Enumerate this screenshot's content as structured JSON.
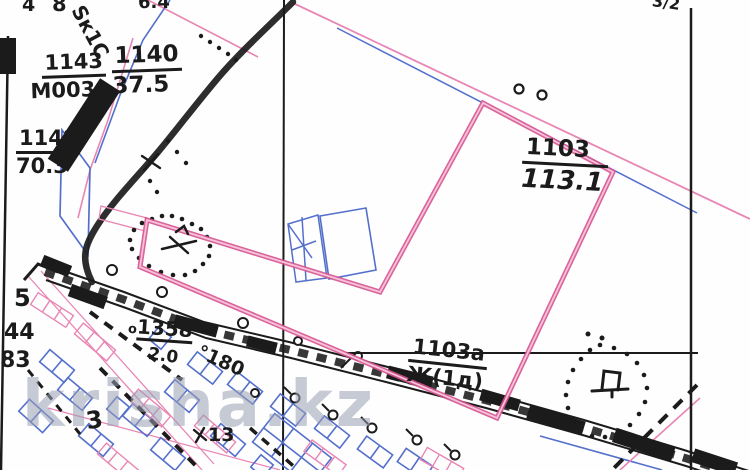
{
  "map": {
    "type": "cadastral-plan-scan",
    "watermark": "krisha.kz",
    "colors": {
      "parcel_outline": "#d6538f",
      "thin_pink": "#e886b4",
      "survey_blue": "#5470cc",
      "ink": "#1b1b1b",
      "watermark_gray": "#9aa0b5"
    },
    "labels": {
      "top_edge_a": "4",
      "top_edge_b": "8",
      "top_edge_script": "Ѕк1С",
      "top_edge_c": "6.4",
      "top_right_corner": "3/2",
      "parcel_1143": {
        "num": "1143",
        "den": "М003"
      },
      "parcel_1140": {
        "num": "1140",
        "den": "37.5"
      },
      "parcel_1148": {
        "num": "1148",
        "den": "70.3"
      },
      "parcel_1103": {
        "num": "1103",
        "den": "113.1"
      },
      "parcel_1103a": {
        "num": "1103а",
        "den": "Ж(1д)"
      },
      "survey_point_prefix": "о",
      "survey_point_1358": "1358",
      "measure_20": "2.0",
      "measure_180": "°180",
      "left_5": "5",
      "left_44": "44",
      "left_83": "83",
      "village_3": "3",
      "village_13": "13"
    }
  }
}
